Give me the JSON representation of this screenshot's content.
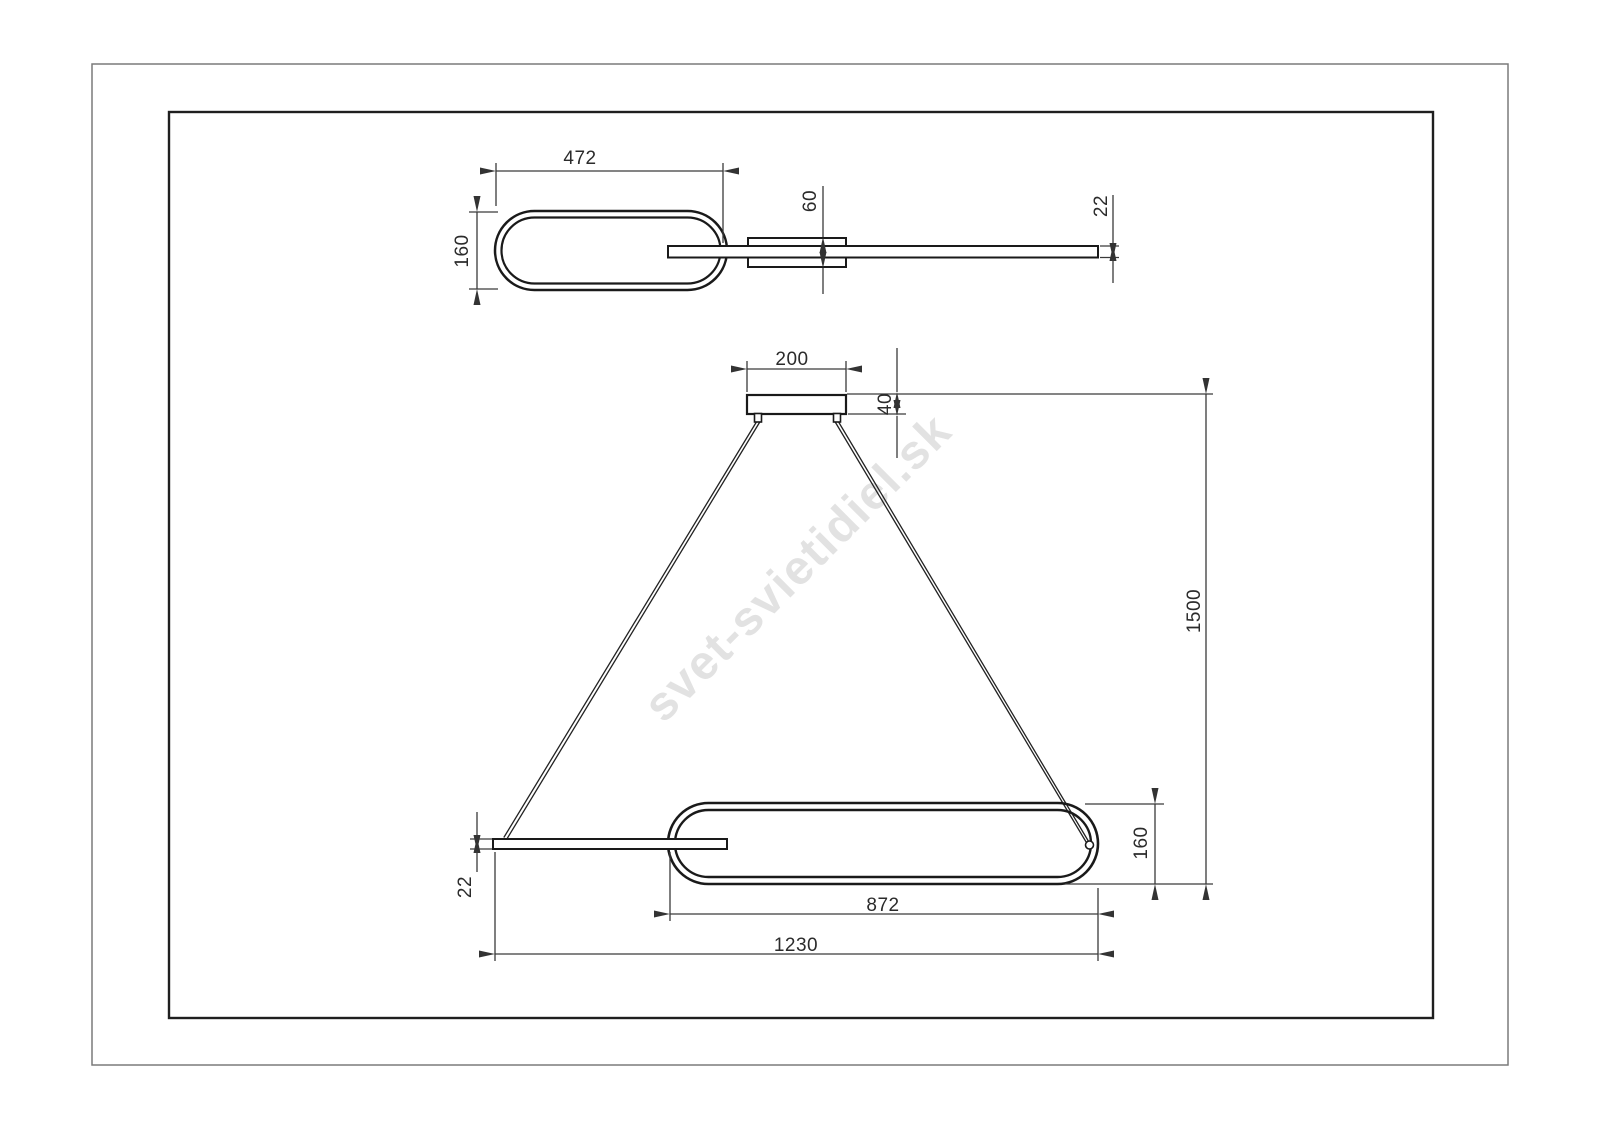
{
  "page": {
    "watermark": "svet-svietidiel.sk"
  },
  "colors": {
    "object_line": "#1a1a1a",
    "dimension_line": "#3a3a3a",
    "watermark": "#e2e2e2",
    "background": "#ffffff"
  },
  "drawing": {
    "description": "Two-view dimensional drawing of an oval pendant light fixture",
    "top_view": {
      "oval_length": "472",
      "oval_width": "160",
      "canopy_depth": "60",
      "profile_thickness": "22"
    },
    "front_view": {
      "canopy_width": "200",
      "canopy_height": "40",
      "suspension_drop": "1500",
      "ring_height": "160",
      "profile_thickness": "22",
      "ring_length": "872",
      "overall_length": "1230"
    }
  }
}
